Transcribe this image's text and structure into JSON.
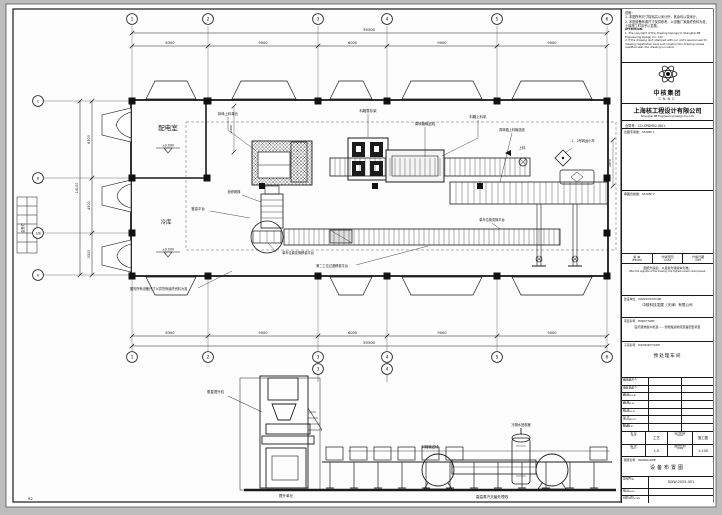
{
  "sheet": {
    "corner_mark": "R2",
    "side_table_label": "会签栏"
  },
  "notes": {
    "cn_title": "说明：",
    "cn_lines": [
      "1. 本图所有尺寸除标高以米计外，其余均以毫米计。",
      "2. 本图设备布置尺寸仅供参考，以设备厂家最终资料为准，土建施工时请予以复核。"
    ],
    "en_title": "ATTENTION:",
    "en_lines": [
      "1. The copyright of the drawing belongs to Shanghai NE Engineering Design Co., Ltd.",
      "2. If the drawing isn't stamped with our unit's special seal for drawing registration seal, and construction drawing review qualified seal, the drawing is invalid."
    ]
  },
  "company": {
    "logo_cn": "中核集团",
    "logo_en": "CNNC",
    "name_cn": "上海核工程设计有限公司",
    "name_en": "Shanghai NE Engineering Design Co.,Ltd.",
    "contract": "合同号：CO-SPDM02-W01"
  },
  "stamps": {
    "stamp1": "出图专用章：STAMP 1",
    "stamp2": "审图合格章：STAMP 2"
  },
  "version": {
    "headers_cn": [
      "版 本",
      "升版原因",
      "升版日期"
    ],
    "headers_en": [
      "VERSION",
      "CAUSE",
      "DATE"
    ],
    "note_cn": "图纸升版后，以最新升级版本为准。",
    "note_en": "After the upgrade of the drawing, the highest version shall prevail."
  },
  "construction_unit": {
    "label_cn": "建设单位：",
    "label_en": "CONSTRUCTION UNIT",
    "value": "中核科技发展（天津）有限公司"
  },
  "project": {
    "label_cn": "项目名称：",
    "label_en": "PROJECT NAME",
    "value": "医疗废物集中处置——智能搬运物流装备配套项目"
  },
  "subproject": {
    "label_cn": "子项名称：",
    "label_en": "SUB-PROJECT NAME",
    "value": "预处理车间"
  },
  "staff": [
    {
      "cn": "项目负责人",
      "en": "PRJ. MGR"
    },
    {
      "cn": "专业负责人",
      "en": "SPEC. MGR"
    },
    {
      "cn": "审 定",
      "en": "APPROVED BY"
    },
    {
      "cn": "审 核",
      "en": "AUDITED BY"
    },
    {
      "cn": "校 对",
      "en": "CHECKED BY"
    },
    {
      "cn": "设 计",
      "en": "DESIGNED BY"
    },
    {
      "cn": "制 图",
      "en": "DRAWN BY"
    }
  ],
  "meta": {
    "prof_label_cn": "专 业",
    "prof_label_en": "PROF.",
    "prof_value": "工艺",
    "stage_label_cn": "设计阶段",
    "stage_label_en": "STAGE",
    "stage_value": "施工图",
    "rev_label_cn": "版 次",
    "rev_label_en": "REV.",
    "rev_value": "1.0",
    "scale_label_cn": "图纸比例",
    "scale_label_en": "SCALE",
    "scale_value": "1:100"
  },
  "drawing_title": {
    "label_cn": "图纸名称：",
    "label_en": "DRAWING NAME",
    "value": "设备布置图",
    "projno_label_cn": "项目编号",
    "projno_label_en": "PROJECT No.",
    "projno": "SJXW-2025-001",
    "drawno_label_cn": "图 号",
    "drawno_label_en": "DRAWING No.",
    "drawno": "",
    "pub_label_cn": "出版日期",
    "pub_label_en": "PUBLICATION DATE",
    "pub": ""
  },
  "plan": {
    "grid_cols": [
      "1",
      "2",
      "3",
      "4",
      "5",
      "6"
    ],
    "grid_rows": [
      "C",
      "B",
      "1/B",
      "A"
    ],
    "dim_total_top": "39300",
    "dim_spans_top": [
      "6300",
      "9000",
      "6000",
      "9000",
      "9000"
    ],
    "dim_total_bottom": "39300",
    "dim_spans_bottom": [
      "6300",
      "9000",
      "6000",
      "9000",
      "9000"
    ],
    "dim_total_left": "14100",
    "dim_spans_left": [
      "6300",
      "4500",
      "3300"
    ],
    "dim_inner": [
      "2600",
      "2850"
    ],
    "rooms": [
      {
        "name": "配电室",
        "elev": "±0.000"
      },
      {
        "name": "冷库",
        "elev": "±0.000"
      }
    ],
    "labels": [
      "拆垛上料单元",
      "料箱暂存架",
      "周转箱输送线",
      "料箱上料机",
      "周转箱上料输送线",
      "上料",
      "1、2号转运小车",
      "登高平台",
      "检修爬梯",
      "单车位置变换移载平台",
      "第二工位过渡移载平台",
      "单车位置变换平台"
    ],
    "note": "图内所有设备尺寸以供货商最终资料为准"
  },
  "elevation": {
    "grid_cols": [
      "3",
      "4"
    ],
    "labels": [
      "垂直提升机",
      "料箱输送线",
      "冷凝水回收器",
      "提升单元",
      "高温蒸汽灭菌处理线"
    ]
  }
}
